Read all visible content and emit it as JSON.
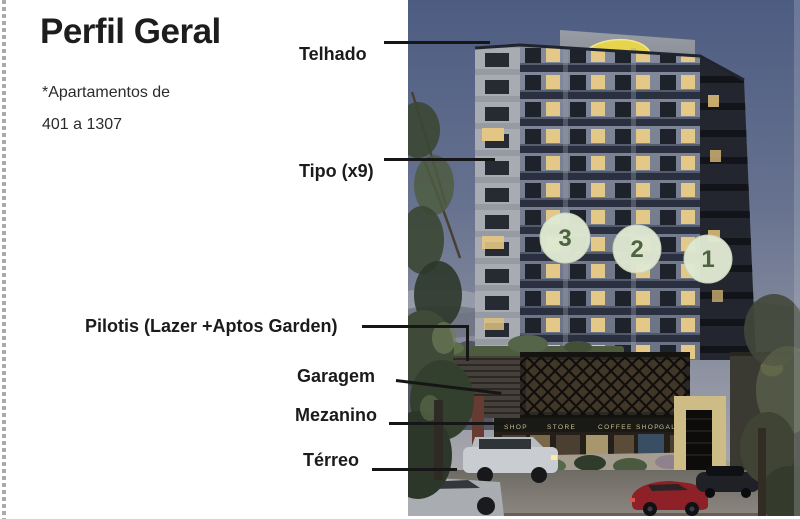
{
  "slide": {
    "title": "Perfil Geral",
    "subtitle_line1": "*Apartamentos de",
    "subtitle_line2": "401 a 1307"
  },
  "annotations": [
    {
      "text": "Telhado"
    },
    {
      "text": "Tipo (x9)"
    },
    {
      "text": "Pilotis (Lazer +Aptos Garden)"
    },
    {
      "text": "Garagem"
    },
    {
      "text": "Mezanino"
    },
    {
      "text": "Térreo"
    }
  ],
  "building": {
    "billboard_text": "CANAL",
    "markers": [
      "3",
      "2",
      "1"
    ],
    "storefront_signs": [
      "SHOP",
      "STORE",
      "COFFEE SHOP",
      "GALLERY"
    ]
  },
  "icons": {
    "marker_circle": "numbered-tower-marker",
    "billboard": "rooftop-brand-billboard"
  },
  "colors": {
    "leader_line": "#161616",
    "title_text": "#1d1d1d",
    "marker_fill": "#dfe8d2",
    "marker_text": "#4e6340",
    "billboard_yellow": "#e7d44c",
    "billboard_blue": "#3c67ac",
    "sky_top": "#4d5c82",
    "sky_bottom": "#b5b2b4"
  }
}
